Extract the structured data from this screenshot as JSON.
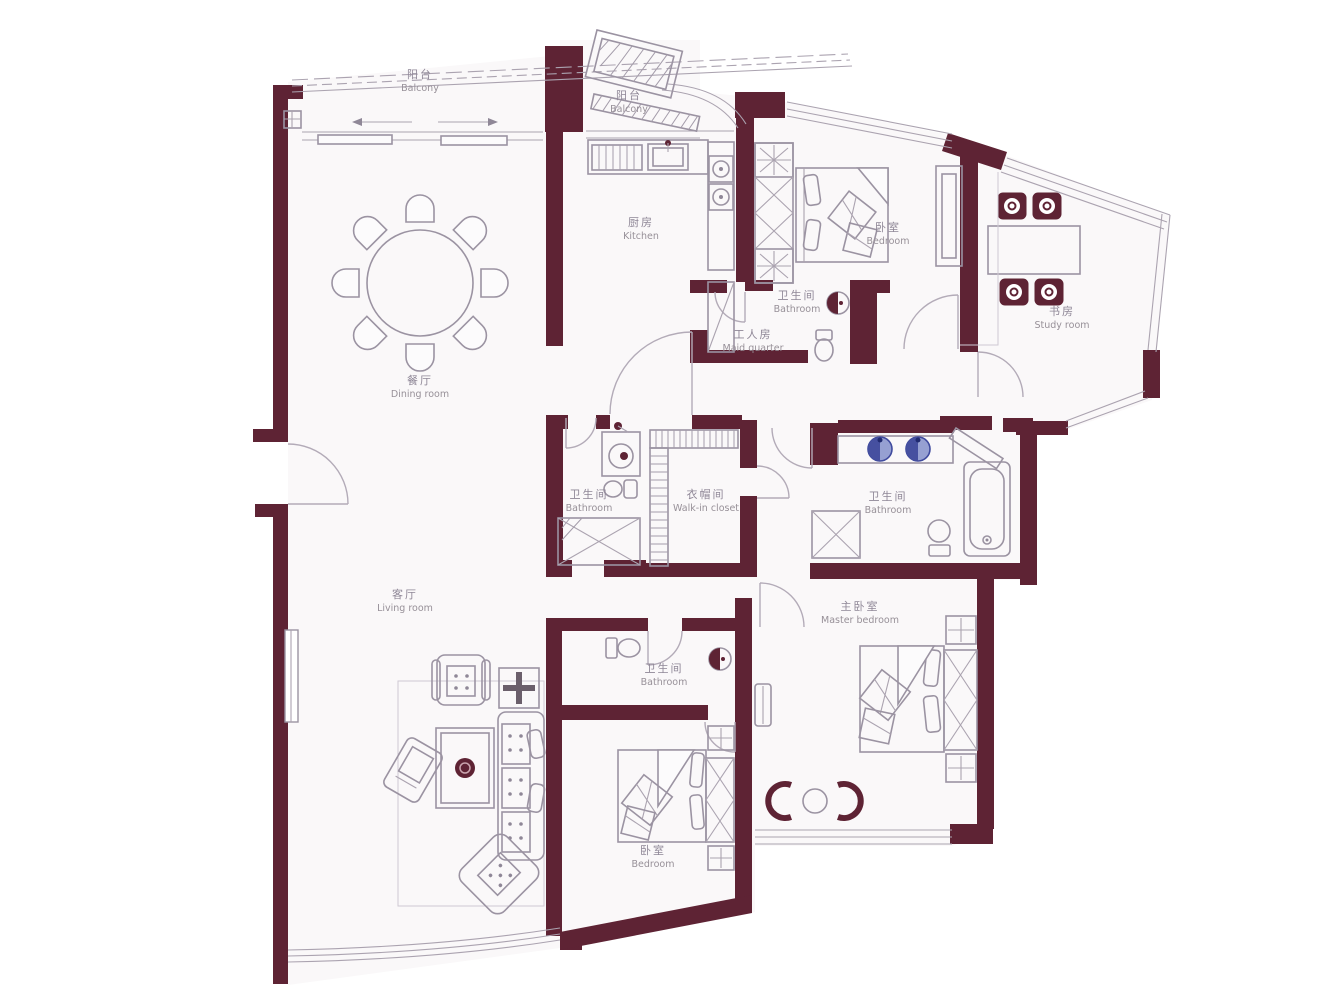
{
  "plan": {
    "type": "apartment-floor-plan",
    "colors": {
      "wall": "#5E2334",
      "furniture_line": "#9B93A2",
      "label_text": "#8F8797",
      "sink_blue": "#7C86C0",
      "sink_blue_dark": "#3F4A9E",
      "floor": "#FAF8F9"
    },
    "rooms": [
      {
        "id": "balcony-main",
        "zh": "阳台",
        "en": "Balcony",
        "x": 420,
        "y": 78
      },
      {
        "id": "balcony-kitchen",
        "zh": "阳台",
        "en": "Balcony",
        "x": 629,
        "y": 99
      },
      {
        "id": "kitchen",
        "zh": "厨房",
        "en": "Kitchen",
        "x": 641,
        "y": 226
      },
      {
        "id": "bedroom-top",
        "zh": "卧室",
        "en": "Bedroom",
        "x": 888,
        "y": 231
      },
      {
        "id": "study",
        "zh": "书房",
        "en": "Study room",
        "x": 1062,
        "y": 315
      },
      {
        "id": "bathroom-maid",
        "zh": "卫生间",
        "en": "Bathroom",
        "x": 797,
        "y": 299
      },
      {
        "id": "maid-quarter",
        "zh": "工人房",
        "en": "Maid quarter",
        "x": 753,
        "y": 338
      },
      {
        "id": "dining-room",
        "zh": "餐厅",
        "en": "Dining room",
        "x": 420,
        "y": 384
      },
      {
        "id": "bathroom-middle",
        "zh": "卫生间",
        "en": "Bathroom",
        "x": 589,
        "y": 498
      },
      {
        "id": "walk-in-closet",
        "zh": "衣帽间",
        "en": "Walk-in closet",
        "x": 706,
        "y": 498
      },
      {
        "id": "bathroom-master",
        "zh": "卫生间",
        "en": "Bathroom",
        "x": 888,
        "y": 500
      },
      {
        "id": "living-room",
        "zh": "客厅",
        "en": "Living room",
        "x": 405,
        "y": 598
      },
      {
        "id": "bathroom-small",
        "zh": "卫生间",
        "en": "Bathroom",
        "x": 664,
        "y": 672
      },
      {
        "id": "master-bedroom",
        "zh": "主卧室",
        "en": "Master bedroom",
        "x": 860,
        "y": 610
      },
      {
        "id": "bedroom-bottom",
        "zh": "卧室",
        "en": "Bedroom",
        "x": 653,
        "y": 854
      }
    ]
  }
}
